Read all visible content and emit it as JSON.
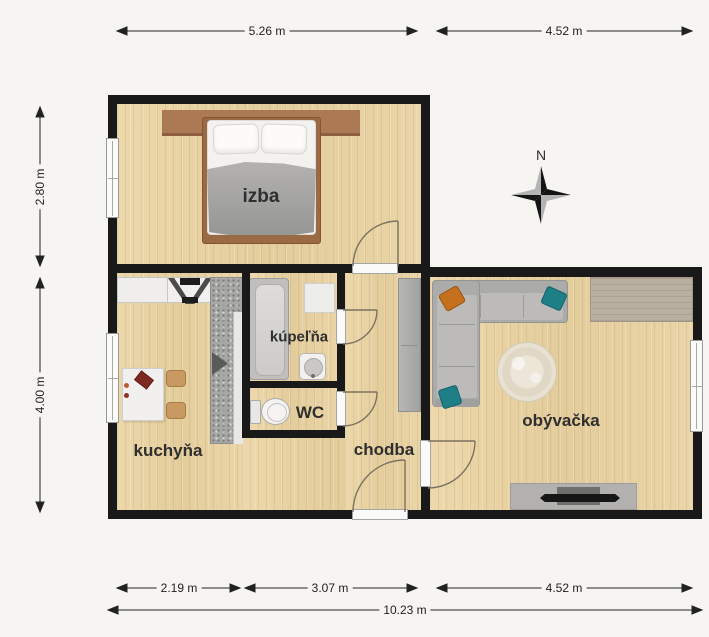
{
  "meta": {
    "type": "apartment-floor-plan"
  },
  "compass": {
    "north_label": "N"
  },
  "rooms": {
    "bedroom": {
      "label": "izba"
    },
    "bathroom": {
      "label": "kúpeľňa"
    },
    "toilet": {
      "label": "WC"
    },
    "kitchen": {
      "label": "kuchyňa"
    },
    "hallway": {
      "label": "chodba"
    },
    "living_room": {
      "label": "obývačka"
    }
  },
  "dimensions": {
    "top": [
      {
        "label": "5.26 m"
      },
      {
        "label": "4.52 m"
      }
    ],
    "left": [
      {
        "label": "2.80 m"
      },
      {
        "label": "4.00 m"
      }
    ],
    "bottom": [
      {
        "label": "2.19 m"
      },
      {
        "label": "3.07 m"
      },
      {
        "label": "4.52 m"
      }
    ],
    "overall": {
      "label": "10.23 m"
    }
  },
  "colors": {
    "wall": "#191919",
    "floor_wood": "#e9d4a7",
    "background": "#f7f5f2",
    "accent_orange": "#c4701f",
    "accent_teal": "#1f7f87",
    "sofa_gray": "#b0b0ae"
  }
}
